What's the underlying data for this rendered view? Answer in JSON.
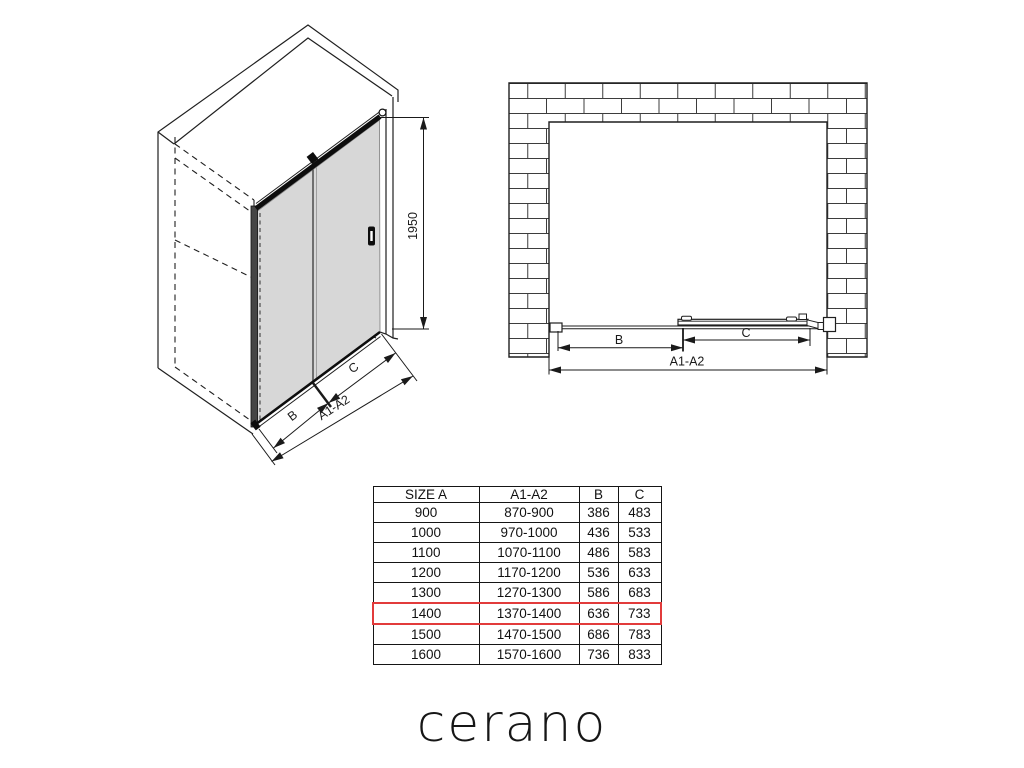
{
  "iso_view": {
    "labels": {
      "height": "1950",
      "b": "B",
      "c": "C",
      "total": "A1-A2"
    },
    "glass_color": "#d7d7d7",
    "line_color": "#1f1f1f"
  },
  "front_view": {
    "labels": {
      "b": "B",
      "c": "C",
      "total": "A1-A2"
    }
  },
  "table": {
    "headers": [
      "SIZE A",
      "A1-A2",
      "B",
      "C"
    ],
    "rows": [
      [
        "900",
        "870-900",
        "386",
        "483"
      ],
      [
        "1000",
        "970-1000",
        "436",
        "533"
      ],
      [
        "1100",
        "1070-1100",
        "486",
        "583"
      ],
      [
        "1200",
        "1170-1200",
        "536",
        "633"
      ],
      [
        "1300",
        "1270-1300",
        "586",
        "683"
      ],
      [
        "1400",
        "1370-1400",
        "636",
        "733"
      ],
      [
        "1500",
        "1470-1500",
        "686",
        "783"
      ],
      [
        "1600",
        "1570-1600",
        "736",
        "833"
      ]
    ],
    "highlight_row_index": 5,
    "highlight_color": "#e23b3b"
  },
  "logo": {
    "text": "cerano"
  }
}
